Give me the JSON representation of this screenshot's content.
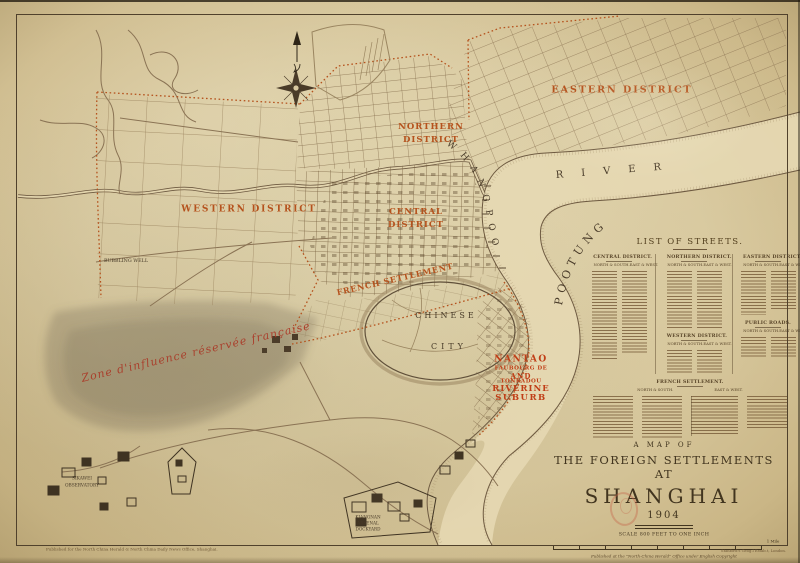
{
  "map_labels": {
    "districts": {
      "eastern": "EASTERN DISTRICT",
      "northern_line1": "NORTHERN",
      "northern_line2": "DISTRICT",
      "central_line1": "CENTRAL",
      "central_line2": "DISTRICT",
      "western": "WESTERN DISTRICT",
      "french": "FRENCH SETTLEMENT"
    },
    "water": {
      "whangpoo": "WHANGPOO",
      "river": "RIVER",
      "pootung": "POOTUNG"
    },
    "places": {
      "chinese_city_line1": "CHINESE",
      "chinese_city_line2": "CITY",
      "bubbling_well": "BUBBLING WELL",
      "sikawei_line1": "SIKAWEI",
      "sikawei_line2": "OBSERVATORY",
      "arsenal_line1": "KIANGNAN",
      "arsenal_line2": "ARSENAL",
      "arsenal_line3": "DOCKYARD"
    },
    "nantao": {
      "line1": "NANTAO",
      "line2": "FAUBOURG DE",
      "line3": "AND",
      "line4": "TONKADOU",
      "line5": "RIVERINE",
      "line6": "SUBURB"
    },
    "french_zone_script": "Zone d'influence réservée française"
  },
  "streets_panel": {
    "title": "LIST OF STREETS.",
    "sections": [
      {
        "title": "CENTRAL DISTRICT.",
        "sub_left": "NORTH & SOUTH.",
        "sub_right": "EAST & WEST."
      },
      {
        "title": "NORTHERN DISTRICT.",
        "sub_left": "NORTH & SOUTH.",
        "sub_right": "EAST & WEST."
      },
      {
        "title": "EASTERN DISTRICT.",
        "sub_left": "NORTH & SOUTH.",
        "sub_right": "EAST & WEST."
      },
      {
        "title": "WESTERN DISTRICT.",
        "sub_left": "NORTH & SOUTH.",
        "sub_right": "EAST & WEST."
      },
      {
        "title": "PUBLIC ROADS.",
        "sub_left": "NORTH & SOUTH.",
        "sub_right": "EAST & WEST."
      },
      {
        "title": "FRENCH SETTLEMENT.",
        "sub_left": "NORTH & SOUTH.",
        "sub_right": "EAST & WEST."
      }
    ]
  },
  "title_block": {
    "line1": "A MAP OF",
    "line2": "THE FOREIGN SETTLEMENTS AT",
    "line3": "SHANGHAI",
    "line4": "1904",
    "scale_note": "SCALE 800 FEET TO ONE INCH",
    "scale_end_label": "1 Mile",
    "imprint": "Published at the \"North-China Herald\" Office under English Copyright"
  },
  "footer": {
    "left_imprint": "Published for the North China Herald & North China Daily News Office, Shanghai.",
    "right_imprint": "Stanford's Geog.l Estab.t, London."
  },
  "icons": {
    "north_arrow": "north-arrow",
    "compass_rose": "compass-rose"
  },
  "colors": {
    "paper": "#d8c89f",
    "district_label": "#b5521d",
    "nantao_red": "#c03e17",
    "ink": "#4a3c2a",
    "frame": "#50412c"
  }
}
